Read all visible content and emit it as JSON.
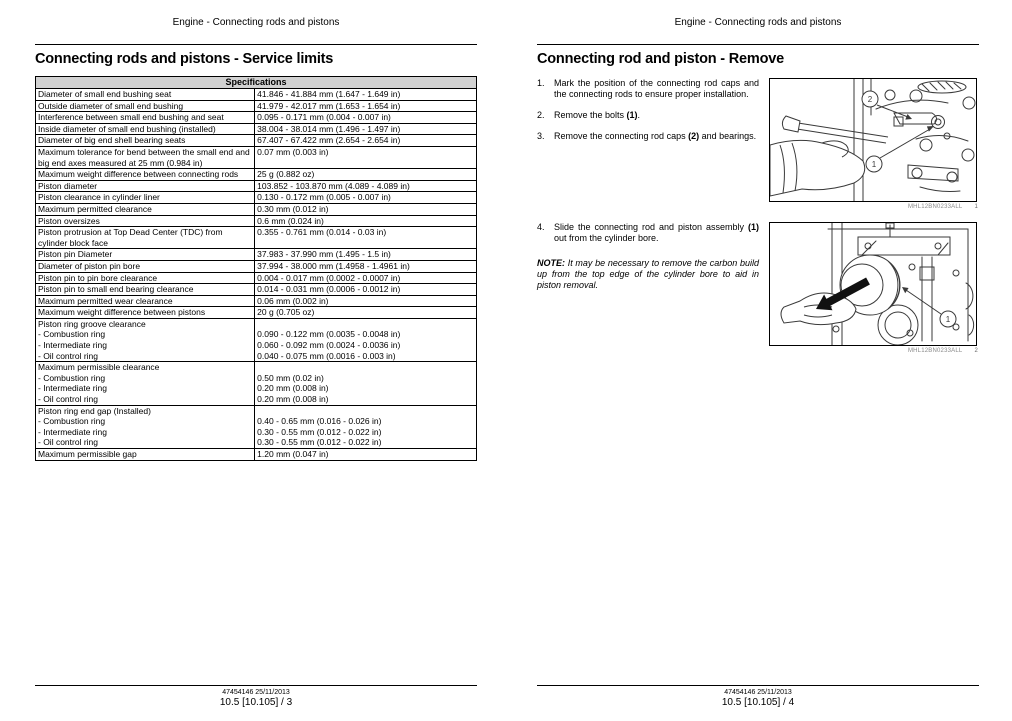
{
  "running_header": "Engine - Connecting rods and pistons",
  "colors": {
    "table_header_bg": "#d2d2d2",
    "line_art_stroke": "#3a3a3a"
  },
  "page_left": {
    "title": "Connecting rods and pistons - Service limits",
    "table": {
      "header": "Specifications",
      "rows": [
        {
          "label": "Diameter of small end bushing seat",
          "value": "41.846 - 41.884 mm (1.647 - 1.649 in)"
        },
        {
          "label": "Outside diameter of small end bushing",
          "value": "41.979 - 42.017 mm (1.653 - 1.654 in)"
        },
        {
          "label": "Interference between small end bushing and seat",
          "value": "0.095 - 0.171 mm (0.004 - 0.007 in)"
        },
        {
          "label": "Inside diameter of small end bushing (installed)",
          "value": "38.004 - 38.014 mm (1.496 - 1.497 in)"
        },
        {
          "label": "Diameter of big end shell bearing seats",
          "value": "67.407 - 67.422 mm (2.654 - 2.654 in)"
        },
        {
          "label": "Maximum tolerance for bend between the small end and big end axes measured at 25 mm (0.984 in)",
          "value": "0.07 mm (0.003 in)"
        },
        {
          "label": "Maximum weight difference between connecting rods",
          "value": "25 g (0.882 oz)"
        },
        {
          "label": "Piston diameter",
          "value": "103.852 - 103.870 mm (4.089 - 4.089 in)"
        },
        {
          "label": "Piston clearance in cylinder liner",
          "value": "0.130 - 0.172 mm (0.005 - 0.007 in)"
        },
        {
          "label": "Maximum permitted clearance",
          "value": "0.30 mm (0.012 in)"
        },
        {
          "label": "Piston oversizes",
          "value": "0.6 mm (0.024 in)"
        },
        {
          "label": "Piston protrusion at Top Dead Center (TDC) from cylinder block face",
          "value": "0.355 - 0.761 mm (0.014 - 0.03 in)"
        },
        {
          "label": "Piston pin Diameter",
          "value": "37.983 - 37.990 mm (1.495 - 1.5 in)"
        },
        {
          "label": "Diameter of piston pin bore",
          "value": "37.994 - 38.000 mm (1.4958 - 1.4961 in)"
        },
        {
          "label": "Piston pin to pin bore clearance",
          "value": "0.004 - 0.017 mm (0.0002 - 0.0007 in)"
        },
        {
          "label": "Piston pin to small end bearing clearance",
          "value": "0.014 - 0.031 mm (0.0006 - 0.0012 in)"
        },
        {
          "label": "Maximum permitted wear clearance",
          "value": "0.06 mm (0.002 in)"
        },
        {
          "label": "Maximum weight difference between pistons",
          "value": "20 g (0.705 oz)"
        },
        {
          "group": "Piston ring groove clearance",
          "items": [
            {
              "label": "- Combustion ring",
              "value": "0.090 - 0.122 mm (0.0035 - 0.0048 in)"
            },
            {
              "label": "- Intermediate ring",
              "value": "0.060 - 0.092 mm (0.0024 - 0.0036 in)"
            },
            {
              "label": "- Oil control ring",
              "value": "0.040 - 0.075 mm (0.0016 - 0.003 in)"
            }
          ]
        },
        {
          "group": "Maximum permissible clearance",
          "items": [
            {
              "label": "- Combustion ring",
              "value": "0.50 mm (0.02 in)"
            },
            {
              "label": "- Intermediate ring",
              "value": "0.20 mm (0.008 in)"
            },
            {
              "label": "- Oil control ring",
              "value": "0.20 mm (0.008 in)"
            }
          ]
        },
        {
          "group": "Piston ring end gap (Installed)",
          "items": [
            {
              "label": "- Combustion ring",
              "value": "0.40 - 0.65 mm (0.016 - 0.026 in)"
            },
            {
              "label": "- Intermediate ring",
              "value": "0.30 - 0.55 mm (0.012 - 0.022 in)"
            },
            {
              "label": "- Oil control ring",
              "value": "0.30 - 0.55 mm (0.012 - 0.022 in)"
            }
          ]
        },
        {
          "label": "Maximum permissible gap",
          "value": "1.20 mm (0.047 in)"
        }
      ]
    },
    "footer": {
      "revision": "47454146 25/11/2013",
      "page": "10.5 [10.105] / 3"
    }
  },
  "page_right": {
    "title": "Connecting rod and piston - Remove",
    "steps_a": [
      {
        "num": "1.",
        "segments": [
          {
            "t": "Mark the position of the connecting rod caps and the connecting rods to ensure proper installation.",
            "b": false
          }
        ]
      },
      {
        "num": "2.",
        "segments": [
          {
            "t": "Remove the bolts ",
            "b": false
          },
          {
            "t": "(1)",
            "b": true
          },
          {
            "t": ".",
            "b": false
          }
        ]
      },
      {
        "num": "3.",
        "segments": [
          {
            "t": "Remove the connecting rod caps ",
            "b": false
          },
          {
            "t": "(2)",
            "b": true
          },
          {
            "t": " and bearings.",
            "b": false
          }
        ]
      }
    ],
    "steps_b": [
      {
        "num": "4.",
        "segments": [
          {
            "t": "Slide the connecting rod and piston assembly ",
            "b": false
          },
          {
            "t": "(1)",
            "b": true
          },
          {
            "t": " out from the cylinder bore.",
            "b": false
          }
        ]
      }
    ],
    "note": {
      "label": "NOTE:",
      "text": "It may be necessary to remove the carbon build up from the top edge of the cylinder bore to aid in piston removal."
    },
    "figures": [
      {
        "caption": "MHL12BN0233ALL",
        "caption_num": "1",
        "callouts": [
          "2",
          "1"
        ]
      },
      {
        "caption": "MHL12BN0233ALL",
        "caption_num": "2",
        "callouts": [
          "1"
        ]
      }
    ],
    "footer": {
      "revision": "47454146 25/11/2013",
      "page": "10.5 [10.105] / 4"
    }
  }
}
